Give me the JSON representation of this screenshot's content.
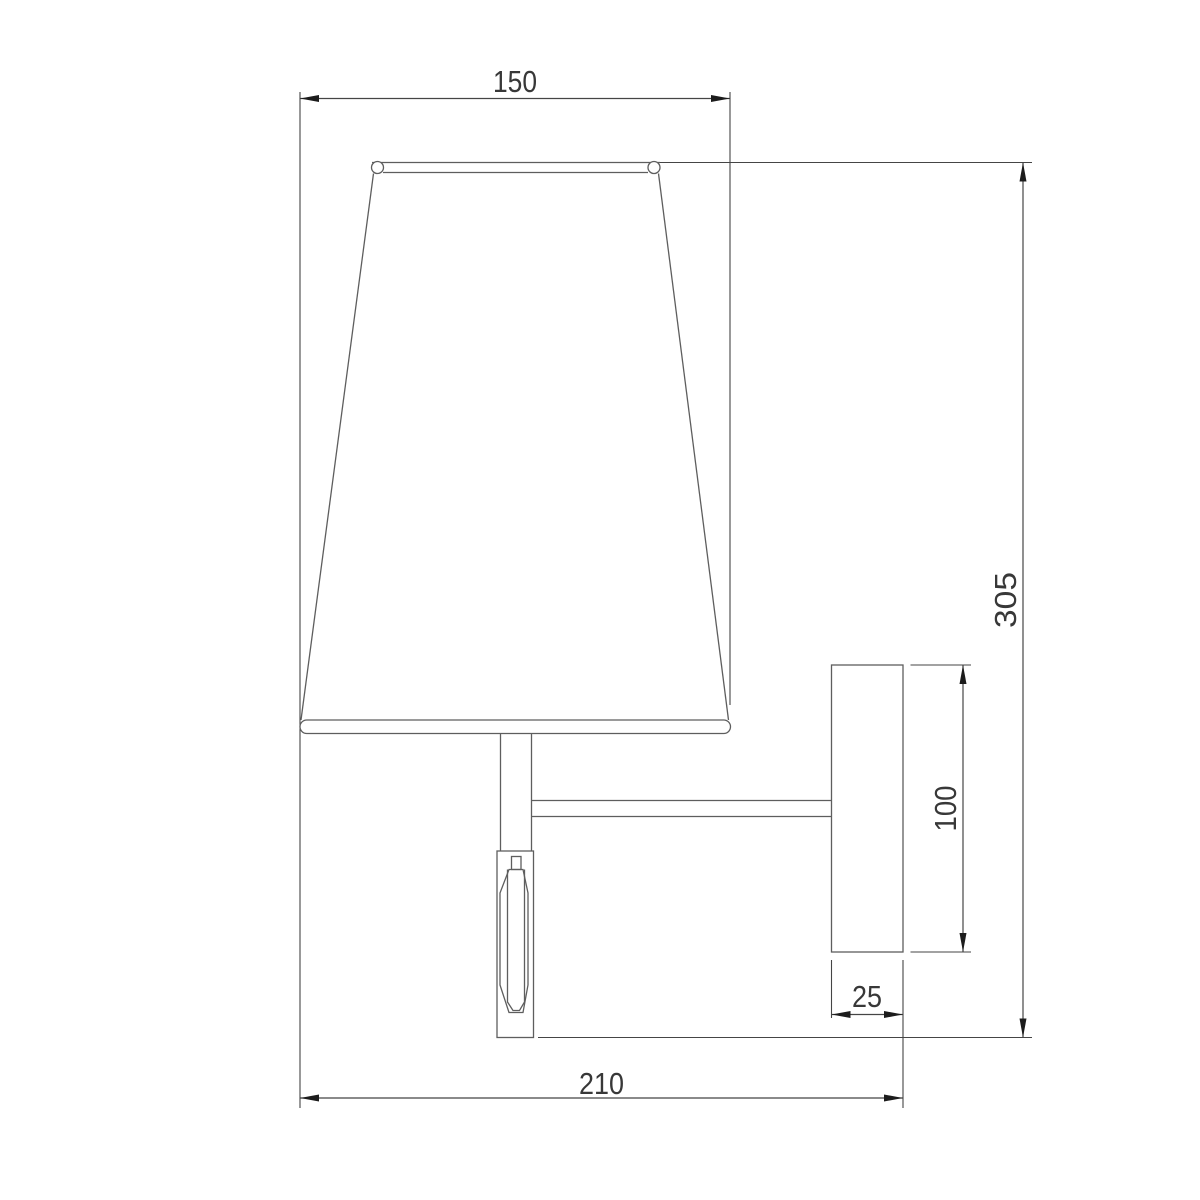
{
  "drawing": {
    "type": "technical-dimension-drawing",
    "subject": "wall-sconce-lamp-side-view",
    "units": "mm",
    "colors": {
      "background": "#ffffff",
      "geometry_line": "#5e5e5e",
      "dimension_line": "#454545",
      "arrowhead": "#1c1c1c",
      "label_text": "#383838"
    },
    "dimensions": {
      "shade_width": {
        "label": "150",
        "orientation": "horizontal",
        "position": "top"
      },
      "overall_height": {
        "label": "305",
        "orientation": "vertical",
        "position": "right"
      },
      "backplate_height": {
        "label": "100",
        "orientation": "vertical",
        "position": "right-of-backplate"
      },
      "backplate_depth": {
        "label": "25",
        "orientation": "horizontal",
        "position": "below-backplate"
      },
      "overall_depth": {
        "label": "210",
        "orientation": "horizontal",
        "position": "bottom"
      }
    }
  }
}
